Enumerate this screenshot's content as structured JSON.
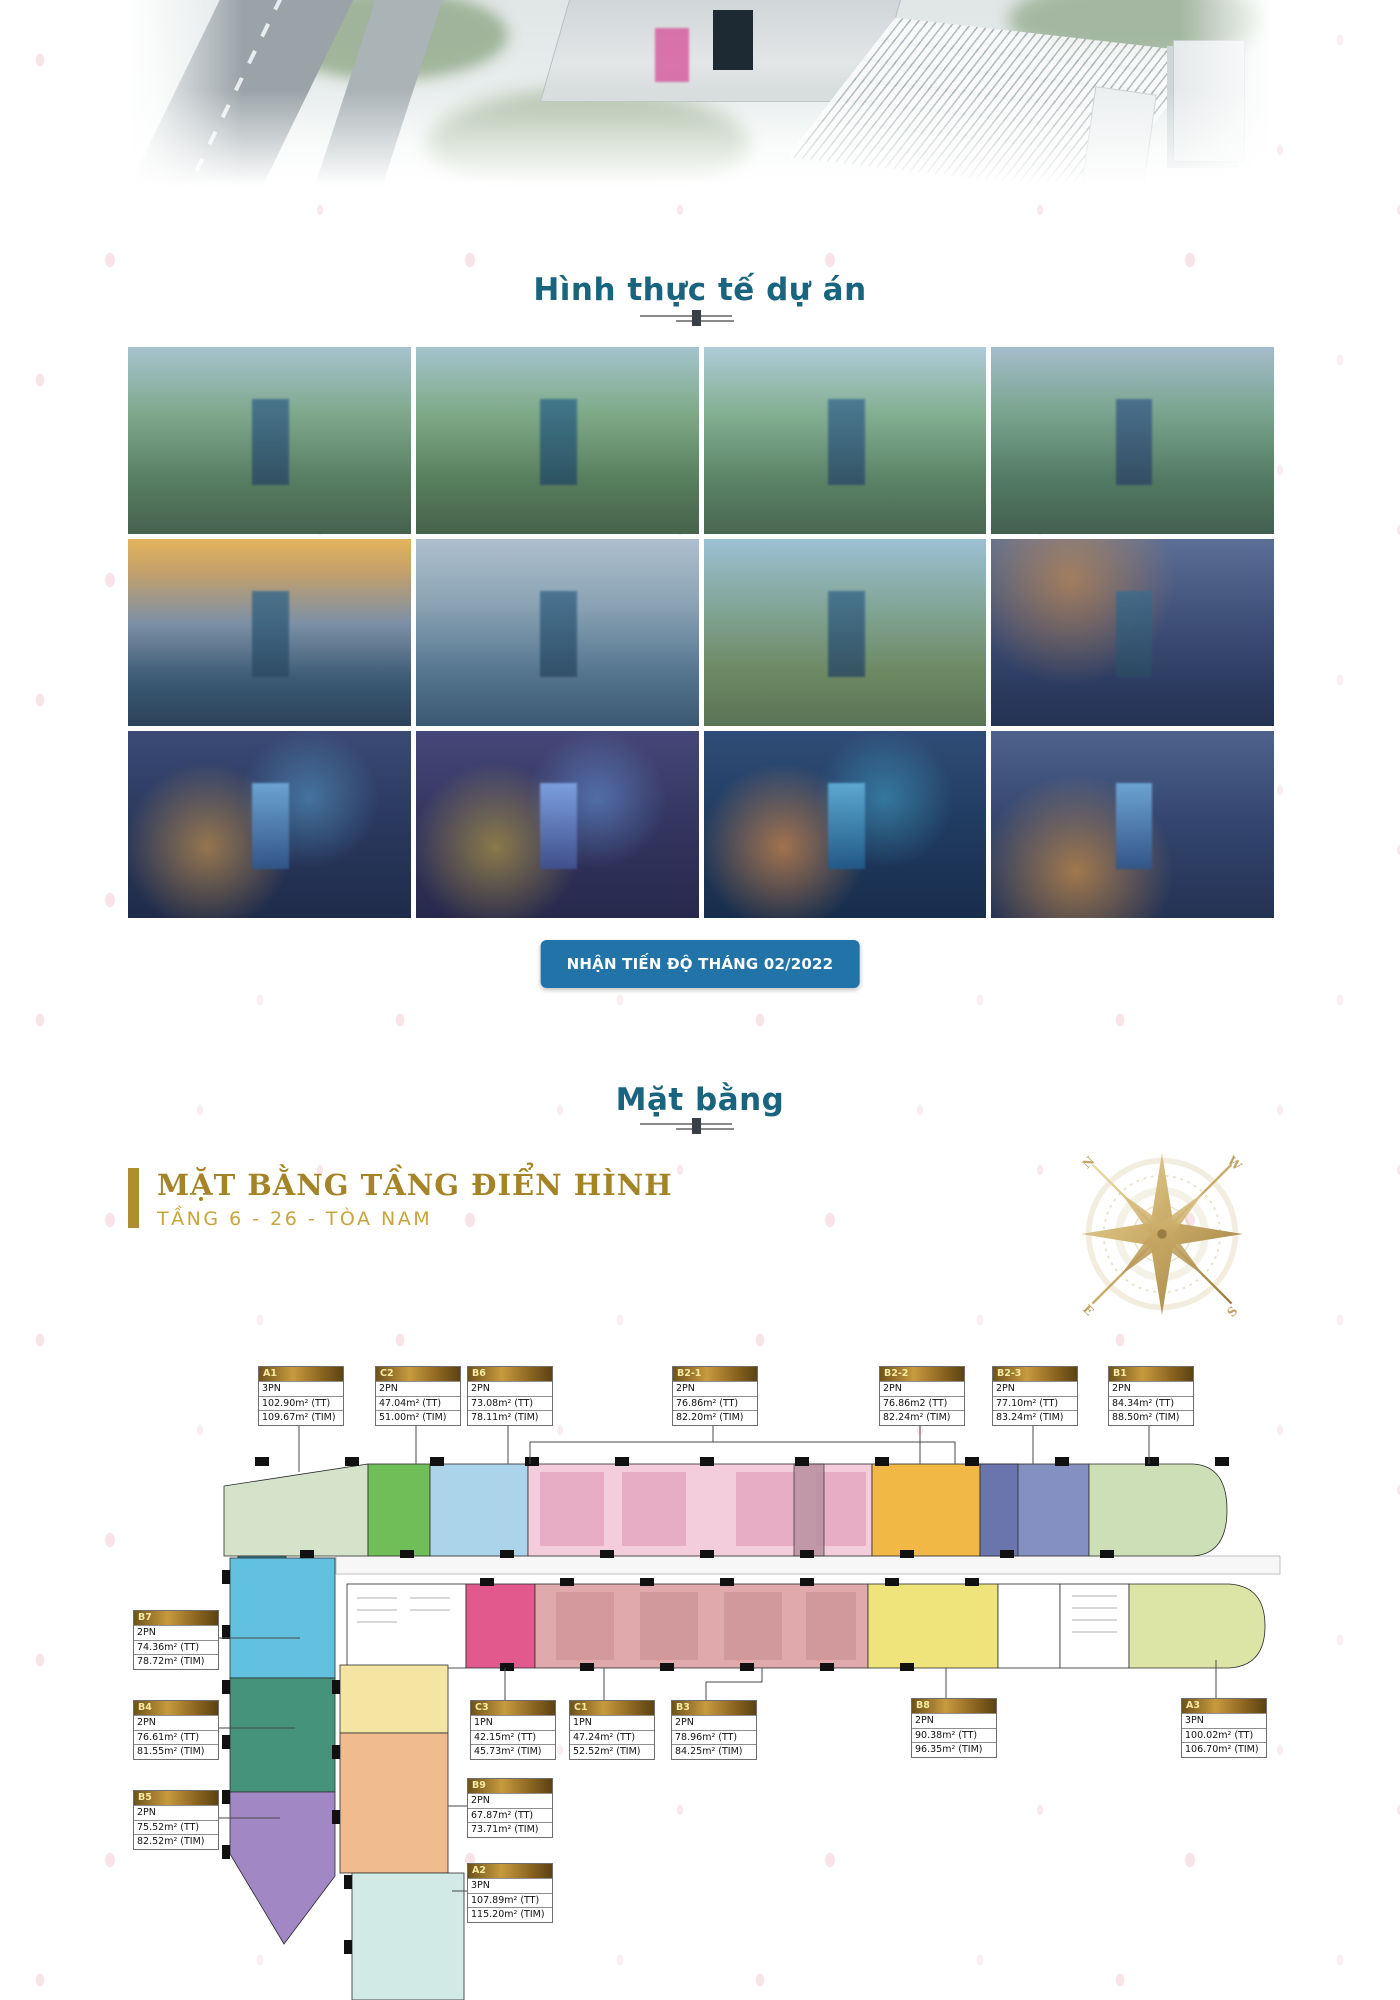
{
  "hero": {
    "name": "project-aerial-render"
  },
  "gallery": {
    "title": "Hình thực tế dự án",
    "photos": [
      "aerial-day-1",
      "aerial-day-2",
      "aerial-day-3",
      "aerial-day-4",
      "aerial-sunset-1",
      "aerial-dusk-1",
      "aerial-day-5",
      "aerial-twilight-1",
      "aerial-night-1",
      "aerial-night-2",
      "aerial-night-3",
      "aerial-night-4"
    ]
  },
  "progress_button": {
    "label": "NHẬN TIẾN ĐỘ THÁNG 02/2022"
  },
  "masterplan": {
    "title": "Mặt bằng"
  },
  "floorplan": {
    "heading": "MẶT BẰNG TẦNG ĐIỂN HÌNH",
    "subheading": "TẦNG 6 - 26 - TÒA NAM",
    "compass": {
      "letters": [
        "N",
        "W",
        "E",
        "S"
      ]
    },
    "zone_colors": {
      "A1": "#d5e3ca",
      "C2": "#6fbe58",
      "B6": "#abd3ea",
      "B2-1": "#f3cddb",
      "B2-2": "#f2b845",
      "B2-3": "#8590c2",
      "B1": "#ccdfb6",
      "B7": "#62c1de",
      "B4": "#46937c",
      "B5": "#a287c5",
      "C3": "#e25a8d",
      "B3": "#e0a9ab",
      "B8": "#efe47c",
      "A3": "#dce4a6",
      "B9": "#f1bc8d",
      "A2": "#d2eae6"
    },
    "units": [
      {
        "id": "A1",
        "bedrooms": "3PN",
        "area_tt": "102.90m² (TT)",
        "area_tim": "109.67m² (TIM)"
      },
      {
        "id": "C2",
        "bedrooms": "2PN",
        "area_tt": "47.04m² (TT)",
        "area_tim": "51.00m² (TIM)"
      },
      {
        "id": "B6",
        "bedrooms": "2PN",
        "area_tt": "73.08m² (TT)",
        "area_tim": "78.11m² (TIM)"
      },
      {
        "id": "B2-1",
        "bedrooms": "2PN",
        "area_tt": "76.86m² (TT)",
        "area_tim": "82.20m² (TIM)"
      },
      {
        "id": "B2-2",
        "bedrooms": "2PN",
        "area_tt": "76.86m2 (TT)",
        "area_tim": "82.24m² (TIM)"
      },
      {
        "id": "B2-3",
        "bedrooms": "2PN",
        "area_tt": "77.10m² (TT)",
        "area_tim": "83.24m² (TIM)"
      },
      {
        "id": "B1",
        "bedrooms": "2PN",
        "area_tt": "84.34m² (TT)",
        "area_tim": "88.50m² (TIM)"
      },
      {
        "id": "B7",
        "bedrooms": "2PN",
        "area_tt": "74.36m² (TT)",
        "area_tim": "78.72m² (TIM)"
      },
      {
        "id": "B4",
        "bedrooms": "2PN",
        "area_tt": "76.61m² (TT)",
        "area_tim": "81.55m² (TIM)"
      },
      {
        "id": "B5",
        "bedrooms": "2PN",
        "area_tt": "75.52m² (TT)",
        "area_tim": "82.52m² (TIM)"
      },
      {
        "id": "C3",
        "bedrooms": "1PN",
        "area_tt": "42.15m² (TT)",
        "area_tim": "45.73m² (TIM)"
      },
      {
        "id": "C1",
        "bedrooms": "1PN",
        "area_tt": "47.24m² (TT)",
        "area_tim": "52.52m² (TIM)"
      },
      {
        "id": "B3",
        "bedrooms": "2PN",
        "area_tt": "78.96m² (TT)",
        "area_tim": "84.25m² (TIM)"
      },
      {
        "id": "B8",
        "bedrooms": "2PN",
        "area_tt": "90.38m² (TT)",
        "area_tim": "96.35m² (TIM)"
      },
      {
        "id": "A3",
        "bedrooms": "3PN",
        "area_tt": "100.02m² (TT)",
        "area_tim": "106.70m² (TIM)"
      },
      {
        "id": "B9",
        "bedrooms": "2PN",
        "area_tt": "67.87m² (TT)",
        "area_tim": "73.71m² (TIM)"
      },
      {
        "id": "A2",
        "bedrooms": "3PN",
        "area_tt": "107.89m² (TT)",
        "area_tim": "115.20m² (TIM)"
      }
    ]
  },
  "colors": {
    "accent_teal": "#19647f",
    "gold": "#a58428",
    "gold_light": "#c7a43e",
    "button_blue": "#2273a8"
  }
}
